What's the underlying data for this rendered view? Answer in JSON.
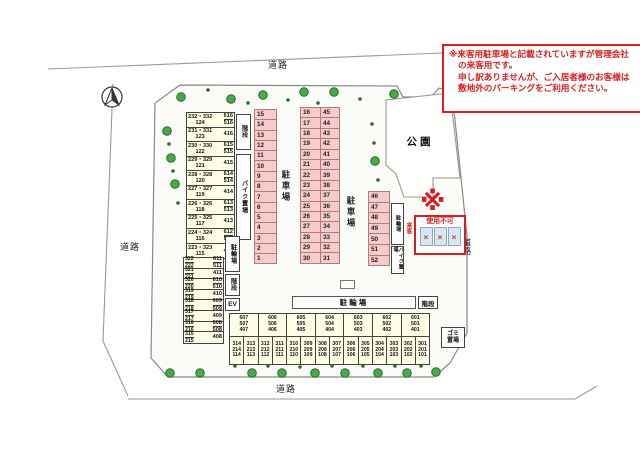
{
  "note_box": {
    "lines": [
      "※来客用駐車場と記載されていますが管理会社",
      "の来客用です。",
      "申し訳ありませんが、ご入居者様のお客様は",
      "敷地外のパーキングをご利用ください。"
    ]
  },
  "roads": {
    "top": "道路",
    "left": "道路",
    "right": "道路",
    "bottom": "道路"
  },
  "park": {
    "label": "公園"
  },
  "left_building": {
    "labels": {
      "stairs_top": "階段",
      "bike": "バイク置場",
      "cycle": "駐輪場",
      "stairs_mid": "階段",
      "elevator": "EV"
    },
    "upper_rows": [
      {
        "main": "232・332",
        "sub": "124",
        "right": [
          "616",
          "516"
        ]
      },
      {
        "main": "231・331",
        "sub": "123",
        "right": [
          "416"
        ]
      },
      {
        "main": "230・330",
        "sub": "122",
        "right": [
          "615",
          "515"
        ]
      },
      {
        "main": "229・329",
        "sub": "121",
        "right": [
          "415"
        ]
      },
      {
        "main": "228・328",
        "sub": "120",
        "right": [
          "614",
          "514"
        ]
      },
      {
        "main": "227・327",
        "sub": "119",
        "right": [
          "414"
        ]
      },
      {
        "main": "226・326",
        "sub": "118",
        "right": [
          "613",
          "513"
        ]
      },
      {
        "main": "225・325",
        "sub": "117",
        "right": [
          "413"
        ]
      },
      {
        "main": "224・324",
        "sub": "116",
        "right": [
          "612",
          "512"
        ]
      },
      {
        "main": "223・323",
        "sub": "115",
        "right": [
          "412"
        ]
      }
    ],
    "lower_rows": [
      {
        "main": "322",
        "sub": "222",
        "right": [
          "611",
          "511"
        ]
      },
      {
        "main": "321",
        "sub": "221",
        "right": [
          "411"
        ]
      },
      {
        "main": "320",
        "sub": "220",
        "right": [
          "610",
          "510"
        ]
      },
      {
        "main": "319",
        "sub": "219",
        "right": [
          "410"
        ]
      },
      {
        "main": "318",
        "sub": "218",
        "right": [
          "609",
          "509"
        ]
      },
      {
        "main": "317",
        "sub": "217",
        "right": [
          "409"
        ]
      },
      {
        "main": "316",
        "sub": "216",
        "right": [
          "608",
          "508"
        ]
      },
      {
        "main": "315",
        "sub": "215",
        "right": [
          "408"
        ]
      }
    ]
  },
  "parking": {
    "label": "駐車場",
    "col_a": [
      "15",
      "14",
      "13",
      "12",
      "11",
      "10",
      "9",
      "8",
      "7",
      "6",
      "5",
      "4",
      "3",
      "2",
      "1"
    ],
    "col_b_left": [
      "16",
      "17",
      "18",
      "19",
      "20",
      "21",
      "22",
      "23",
      "24",
      "25",
      "26",
      "27",
      "28",
      "29",
      "30"
    ],
    "col_b_right": [
      "45",
      "44",
      "43",
      "42",
      "41",
      "40",
      "39",
      "38",
      "37",
      "36",
      "35",
      "34",
      "33",
      "32",
      "31"
    ],
    "col_c": [
      "46",
      "47",
      "48",
      "49",
      "50",
      "51",
      "52"
    ],
    "col_c_labels": {
      "cycle": "駐輪場",
      "bike": "バイク置場"
    }
  },
  "unusable_box": {
    "asterisk": "※",
    "side_label": "来客",
    "title": "使用不可",
    "marks": [
      "×",
      "×",
      "×"
    ]
  },
  "cycle_bar": {
    "label": "駐輪場",
    "stairs": "階段"
  },
  "bottom_building": {
    "bays": [
      {
        "top": [
          "607",
          "507",
          "407"
        ],
        "left": [
          "314",
          "214",
          "114"
        ],
        "right": [
          "313",
          "213",
          "113"
        ]
      },
      {
        "top": [
          "606",
          "506",
          "406"
        ],
        "left": [
          "312",
          "212",
          "112"
        ],
        "right": [
          "311",
          "211",
          "111"
        ]
      },
      {
        "top": [
          "605",
          "505",
          "405"
        ],
        "left": [
          "310",
          "210",
          "110"
        ],
        "right": [
          "309",
          "209",
          "109"
        ]
      },
      {
        "top": [
          "604",
          "504",
          "404"
        ],
        "left": [
          "308",
          "208",
          "108"
        ],
        "right": [
          "307",
          "207",
          "107"
        ]
      },
      {
        "top": [
          "603",
          "503",
          "403"
        ],
        "left": [
          "306",
          "206",
          "106"
        ],
        "right": [
          "305",
          "205",
          "105"
        ]
      },
      {
        "top": [
          "602",
          "502",
          "402"
        ],
        "left": [
          "304",
          "204",
          "104"
        ],
        "right": [
          "303",
          "203",
          "103"
        ]
      },
      {
        "top": [
          "601",
          "501",
          "401"
        ],
        "left": [
          "302",
          "202",
          "102"
        ],
        "right": [
          "301",
          "201",
          "101"
        ]
      }
    ]
  },
  "garbage": {
    "lines": [
      "ゴミ",
      "置場"
    ]
  },
  "colors": {
    "accent_red": "#d42020",
    "parking_pink": "#f5cbcb",
    "building_yellow": "#ffffe6",
    "tree_green": "#4ca64c",
    "unusable_cell_blue": "#d9e6f2"
  }
}
